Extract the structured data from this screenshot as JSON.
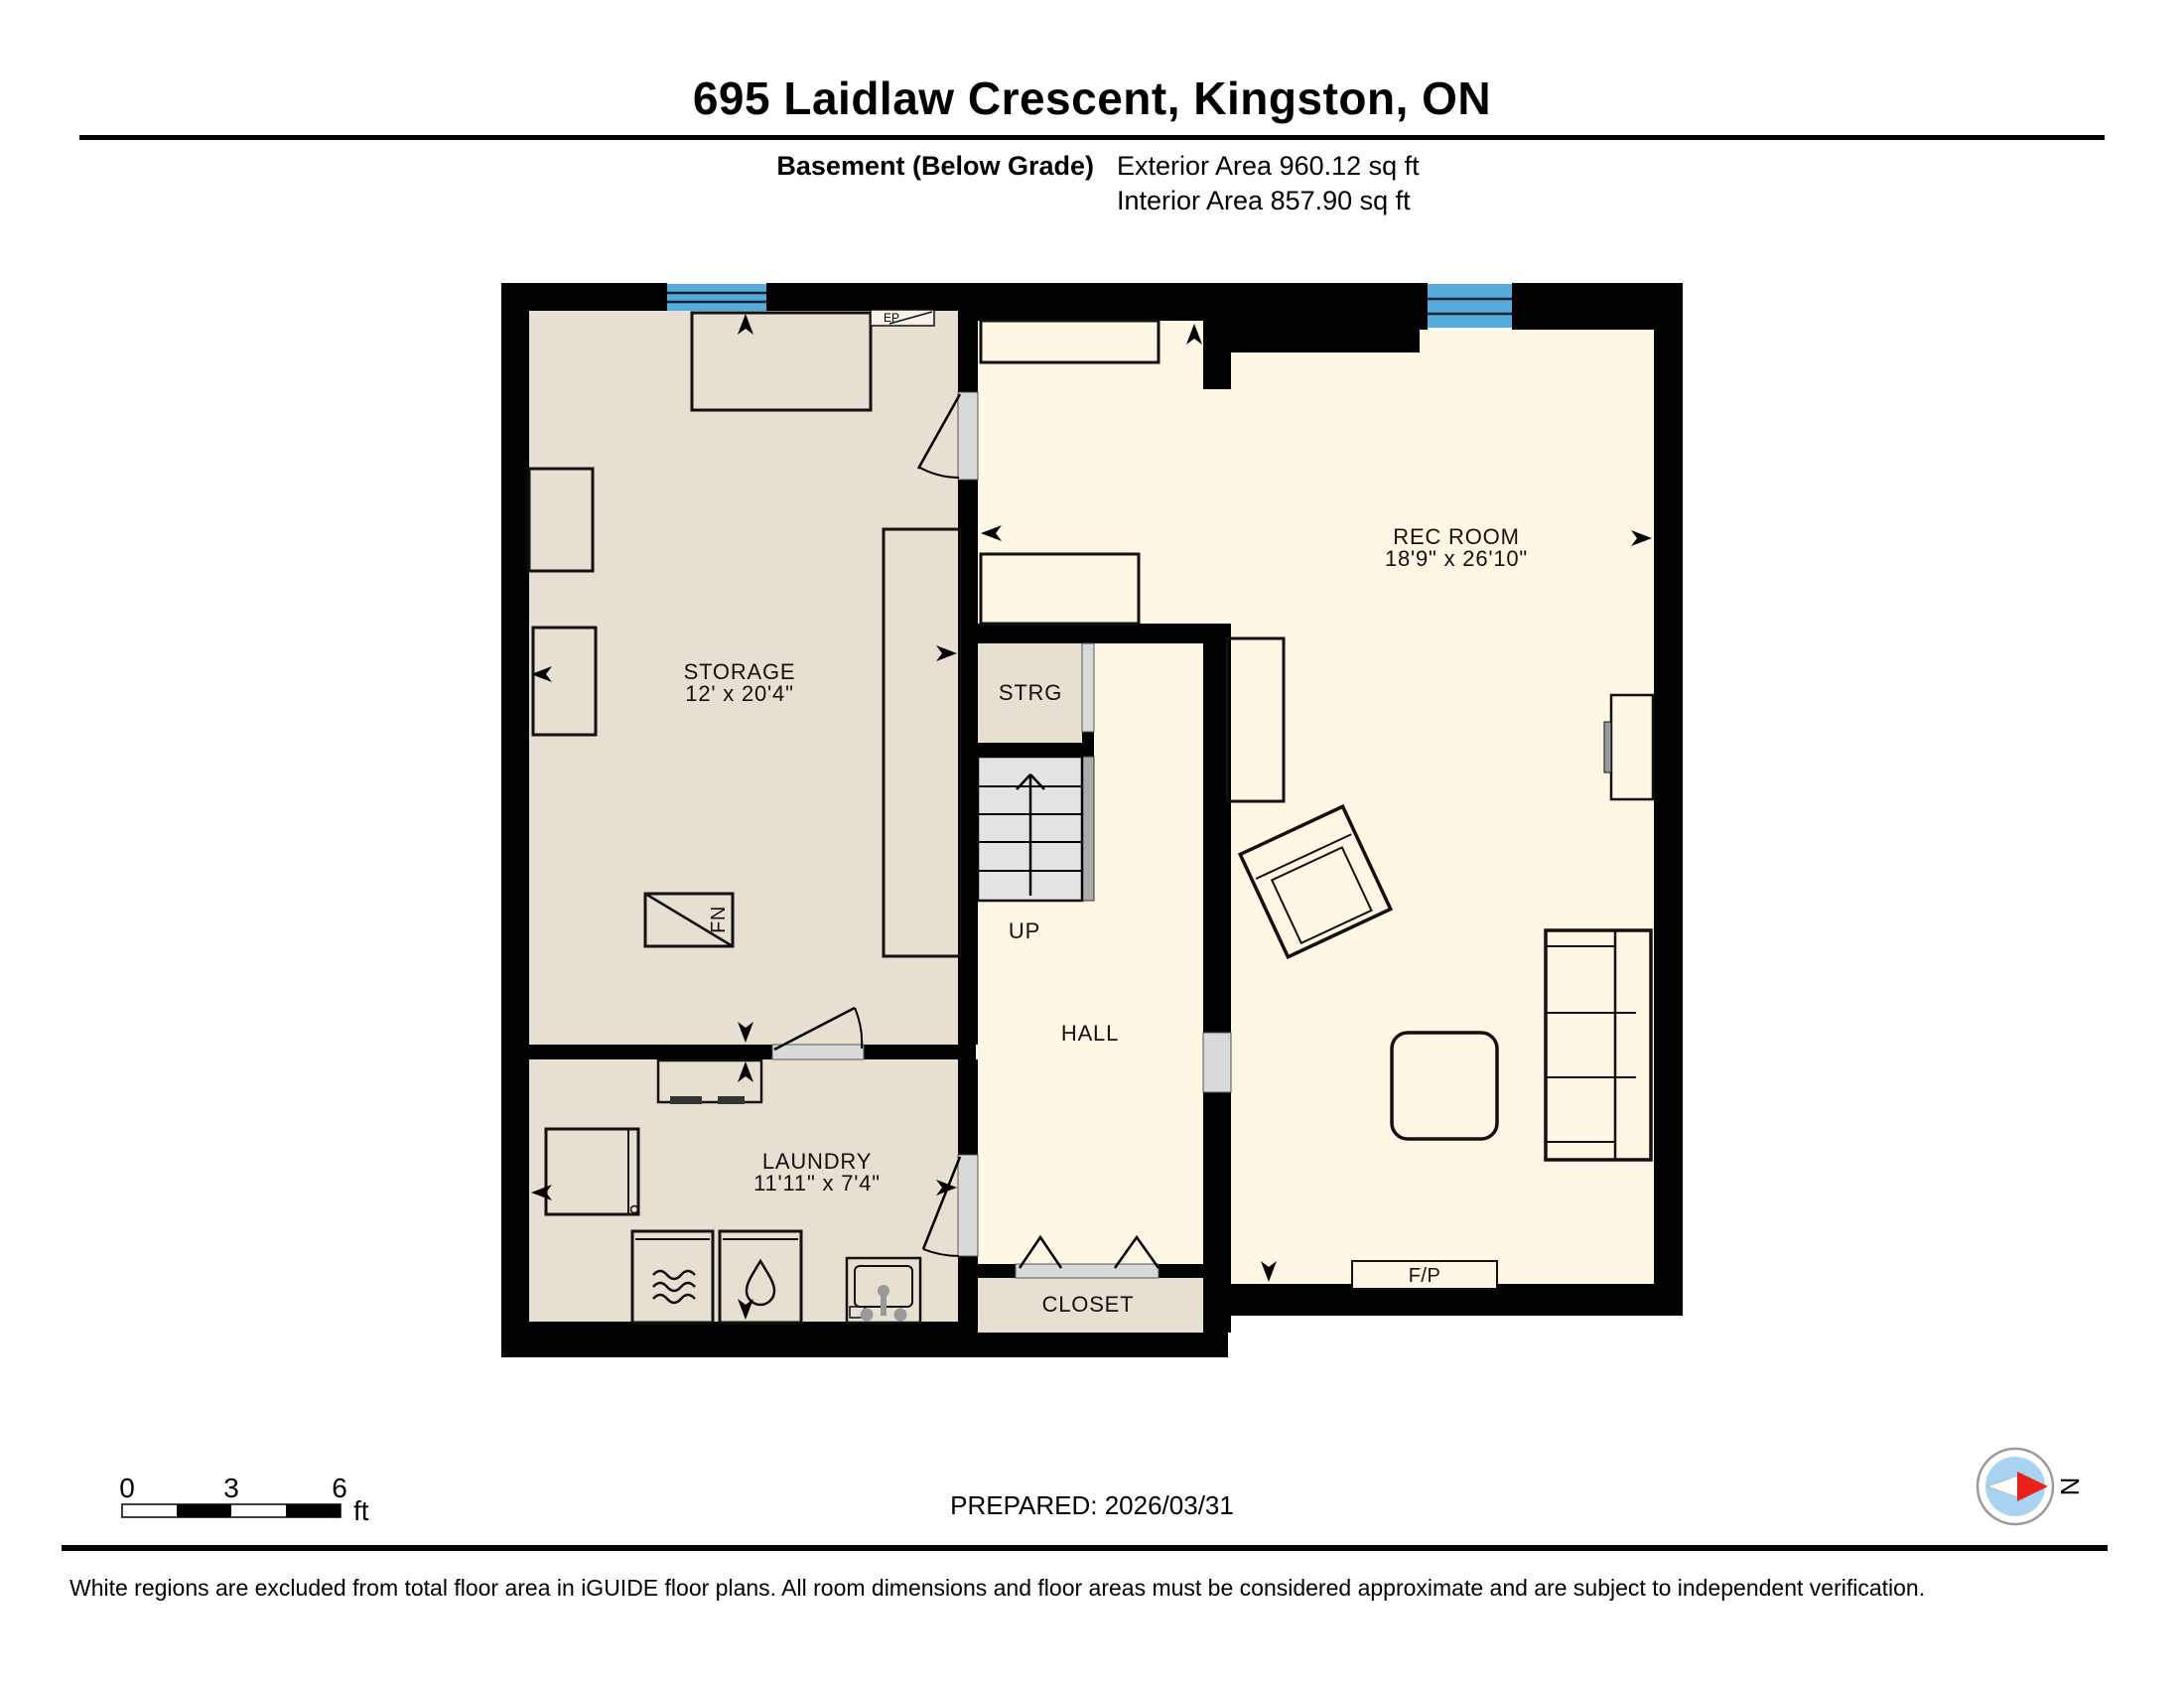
{
  "header": {
    "title": "695 Laidlaw Crescent, Kingston, ON",
    "floor_label": "Basement (Below Grade)",
    "exterior_area": "Exterior Area 960.12 sq ft",
    "interior_area": "Interior Area 857.90 sq ft"
  },
  "rooms": {
    "storage": {
      "label": "STORAGE",
      "dims": "12' x 20'4\""
    },
    "rec_room": {
      "label": "REC ROOM",
      "dims": "18'9\" x 26'10\""
    },
    "laundry": {
      "label": "LAUNDRY",
      "dims": "11'11\" x 7'4\""
    },
    "strg": {
      "label": "STRG"
    },
    "hall": {
      "label": "HALL"
    },
    "up": {
      "label": "UP"
    },
    "closet": {
      "label": "CLOSET"
    },
    "fireplace": {
      "label": "F/P"
    },
    "furnace": {
      "label": "FN"
    },
    "electrical_panel": {
      "label": "EP"
    }
  },
  "scale_bar": {
    "tick0": "0",
    "tick3": "3",
    "tick6": "6",
    "unit": "ft"
  },
  "prepared_label": "PREPARED: 2026/03/31",
  "compass": {
    "north_label": "N"
  },
  "footer_note": "White regions are excluded from total floor area in iGUIDE floor plans. All room dimensions and floor areas must be considered approximate and are subject to independent verification.",
  "colors": {
    "wall": "#000000",
    "room_excluded_fill": "#e8dfd3",
    "room_included_fill": "#fdf7e3",
    "window_blue": "#56abdd",
    "stair_fill": "#e3e3e3",
    "door_sill": "#d9d9d9",
    "stair_rail": "#ababab",
    "compass_disc": "#a9d3f2",
    "compass_needle_red": "#e8211c"
  }
}
